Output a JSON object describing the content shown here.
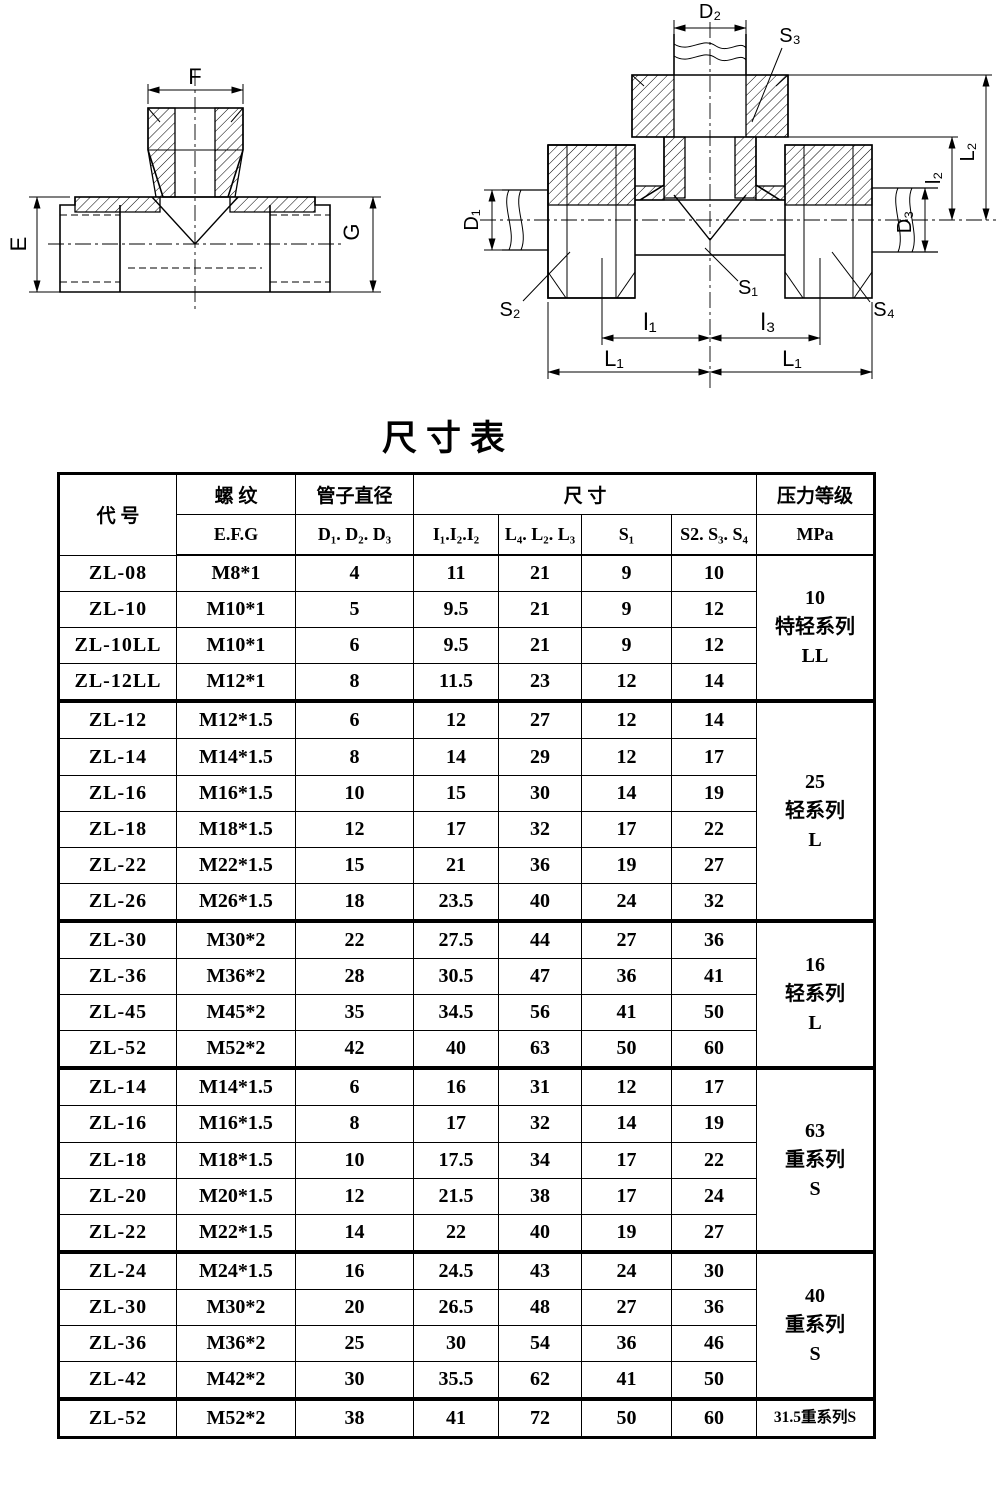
{
  "page": {
    "title": "尺寸表"
  },
  "drawings": {
    "front_view": {
      "labels": {
        "f": "F",
        "e": "E",
        "g": "G"
      }
    },
    "section_view": {
      "labels": {
        "d2": "D₂",
        "s3": "S₃",
        "l2_cap": "L₂",
        "l2": "l₂",
        "d1": "D₁",
        "d3": "D₃",
        "s2": "S₂",
        "s1": "S₁",
        "s4": "S₄",
        "l1": "l₁",
        "l3": "l₃",
        "l1_cap_left": "L₁",
        "l1_cap_right": "L₁"
      }
    }
  },
  "table": {
    "header": {
      "col_code": "代  号",
      "col_thread": "螺  纹",
      "col_thread_sub": "E.F.G",
      "col_pipe_dia": "管子直径",
      "col_pipe_dia_sub": "D₁. D₂. D₃",
      "col_dims": "尺  寸",
      "col_dims_subs": [
        "I₁.I₂.I₂",
        "L₄. L₂. L₃",
        "S₁",
        "S2. S₃. S₄"
      ],
      "col_pressure": "压力等级",
      "col_pressure_sub": "MPa"
    },
    "groups": [
      {
        "pressure_text": "10\n特轻系列\nLL",
        "rows": [
          {
            "code": "ZL-08",
            "thread": "M8*1",
            "dia": "4",
            "i": "11",
            "l": "21",
            "s1": "9",
            "s234": "10"
          },
          {
            "code": "ZL-10",
            "thread": "M10*1",
            "dia": "5",
            "i": "9.5",
            "l": "21",
            "s1": "9",
            "s234": "12"
          },
          {
            "code": "ZL-10LL",
            "thread": "M10*1",
            "dia": "6",
            "i": "9.5",
            "l": "21",
            "s1": "9",
            "s234": "12"
          },
          {
            "code": "ZL-12LL",
            "thread": "M12*1",
            "dia": "8",
            "i": "11.5",
            "l": "23",
            "s1": "12",
            "s234": "14"
          }
        ]
      },
      {
        "pressure_text": "25\n轻系列\nL",
        "rows": [
          {
            "code": "ZL-12",
            "thread": "M12*1.5",
            "dia": "6",
            "i": "12",
            "l": "27",
            "s1": "12",
            "s234": "14"
          },
          {
            "code": "ZL-14",
            "thread": "M14*1.5",
            "dia": "8",
            "i": "14",
            "l": "29",
            "s1": "12",
            "s234": "17"
          },
          {
            "code": "ZL-16",
            "thread": "M16*1.5",
            "dia": "10",
            "i": "15",
            "l": "30",
            "s1": "14",
            "s234": "19"
          },
          {
            "code": "ZL-18",
            "thread": "M18*1.5",
            "dia": "12",
            "i": "17",
            "l": "32",
            "s1": "17",
            "s234": "22"
          },
          {
            "code": "ZL-22",
            "thread": "M22*1.5",
            "dia": "15",
            "i": "21",
            "l": "36",
            "s1": "19",
            "s234": "27"
          },
          {
            "code": "ZL-26",
            "thread": "M26*1.5",
            "dia": "18",
            "i": "23.5",
            "l": "40",
            "s1": "24",
            "s234": "32"
          }
        ]
      },
      {
        "pressure_text": "16\n轻系列\nL",
        "rows": [
          {
            "code": "ZL-30",
            "thread": "M30*2",
            "dia": "22",
            "i": "27.5",
            "l": "44",
            "s1": "27",
            "s234": "36"
          },
          {
            "code": "ZL-36",
            "thread": "M36*2",
            "dia": "28",
            "i": "30.5",
            "l": "47",
            "s1": "36",
            "s234": "41"
          },
          {
            "code": "ZL-45",
            "thread": "M45*2",
            "dia": "35",
            "i": "34.5",
            "l": "56",
            "s1": "41",
            "s234": "50"
          },
          {
            "code": "ZL-52",
            "thread": "M52*2",
            "dia": "42",
            "i": "40",
            "l": "63",
            "s1": "50",
            "s234": "60"
          }
        ]
      },
      {
        "pressure_text": "63\n重系列\nS",
        "rows": [
          {
            "code": "ZL-14",
            "thread": "M14*1.5",
            "dia": "6",
            "i": "16",
            "l": "31",
            "s1": "12",
            "s234": "17"
          },
          {
            "code": "ZL-16",
            "thread": "M16*1.5",
            "dia": "8",
            "i": "17",
            "l": "32",
            "s1": "14",
            "s234": "19"
          },
          {
            "code": "ZL-18",
            "thread": "M18*1.5",
            "dia": "10",
            "i": "17.5",
            "l": "34",
            "s1": "17",
            "s234": "22"
          },
          {
            "code": "ZL-20",
            "thread": "M20*1.5",
            "dia": "12",
            "i": "21.5",
            "l": "38",
            "s1": "17",
            "s234": "24"
          },
          {
            "code": "ZL-22",
            "thread": "M22*1.5",
            "dia": "14",
            "i": "22",
            "l": "40",
            "s1": "19",
            "s234": "27"
          }
        ]
      },
      {
        "pressure_text": "40\n重系列\nS",
        "rows": [
          {
            "code": "ZL-24",
            "thread": "M24*1.5",
            "dia": "16",
            "i": "24.5",
            "l": "43",
            "s1": "24",
            "s234": "30"
          },
          {
            "code": "ZL-30",
            "thread": "M30*2",
            "dia": "20",
            "i": "26.5",
            "l": "48",
            "s1": "27",
            "s234": "36"
          },
          {
            "code": "ZL-36",
            "thread": "M36*2",
            "dia": "25",
            "i": "30",
            "l": "54",
            "s1": "36",
            "s234": "46"
          },
          {
            "code": "ZL-42",
            "thread": "M42*2",
            "dia": "30",
            "i": "35.5",
            "l": "62",
            "s1": "41",
            "s234": "50"
          }
        ]
      },
      {
        "pressure_text": "31.5重系列S",
        "small": true,
        "rows": [
          {
            "code": "ZL-52",
            "thread": "M52*2",
            "dia": "38",
            "i": "41",
            "l": "72",
            "s1": "50",
            "s234": "60"
          }
        ]
      }
    ]
  }
}
